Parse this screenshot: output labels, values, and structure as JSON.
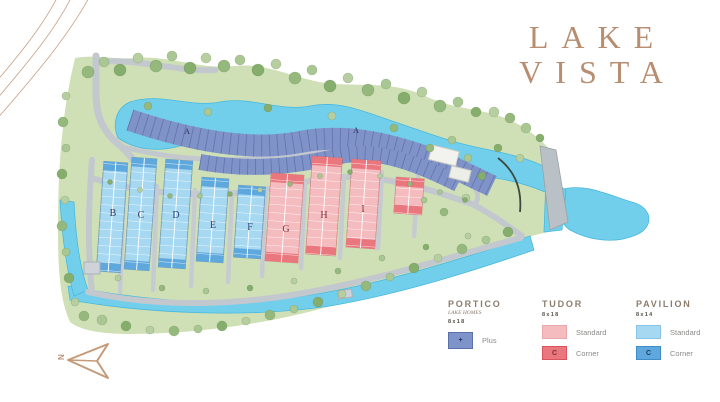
{
  "brand": {
    "line1": "LAKE",
    "line2": "VISTA"
  },
  "compass": {
    "north_label": "N"
  },
  "map": {
    "block_labels": {
      "a1": "A",
      "a2": "A",
      "b": "B",
      "c": "C",
      "d": "D",
      "e": "E",
      "f": "F",
      "g": "G",
      "h": "H",
      "i": "I"
    }
  },
  "legend": {
    "portico": {
      "title": "PORTICO",
      "subtitle": "LAKE HOMES",
      "size": "8x18",
      "plus_symbol": "+",
      "plus_label": "Plus"
    },
    "tudor": {
      "title": "TUDOR",
      "size": "8x18",
      "standard_label": "Standard",
      "corner_symbol": "C",
      "corner_label": "Corner"
    },
    "pavilion": {
      "title": "PAVILION",
      "size": "8x14",
      "standard_label": "Standard",
      "corner_symbol": "C",
      "corner_label": "Corner"
    }
  },
  "colors": {
    "brand": "#b78e70",
    "landscape": "#cfe0b6",
    "water": "#72cfec",
    "road": "#c2c8ce",
    "portico": "#7e93c9",
    "tudor_standard": "#f5bcc0",
    "tudor_corner": "#ea767e",
    "pavilion_standard": "#a6d8f2",
    "pavilion_corner": "#5ea8dd"
  }
}
